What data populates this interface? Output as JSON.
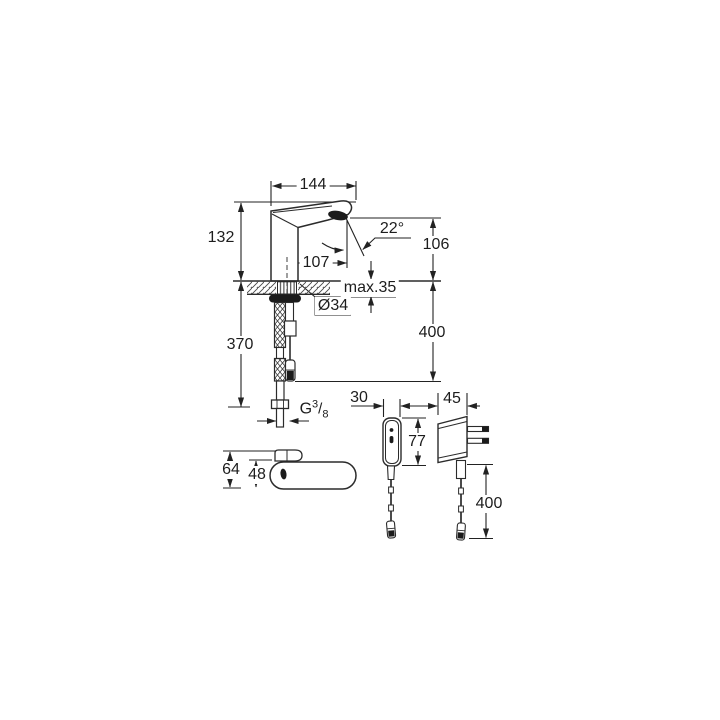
{
  "colors": {
    "line": "#2b2b2b",
    "dim_line": "#222222",
    "dark_fill": "#1b1b1b",
    "background": "#ffffff"
  },
  "labels": {
    "spout_reach": "144",
    "total_height": "132",
    "spout_projection": "107",
    "spray_angle": "22°",
    "outlet_height": "106",
    "max_deck_thickness": "max.35",
    "hole_diameter": "Ø34",
    "hose_length": "370",
    "cable_drop_under_deck": "400",
    "thread_g": "G",
    "thread_num": "3",
    "thread_slash": "/",
    "thread_den": "8",
    "control_box_width": "30",
    "plug_width": "45",
    "control_box_height": "77",
    "top_view_depth_total": "64",
    "top_view_body_depth": "48",
    "plug_cable_drop": "400"
  }
}
